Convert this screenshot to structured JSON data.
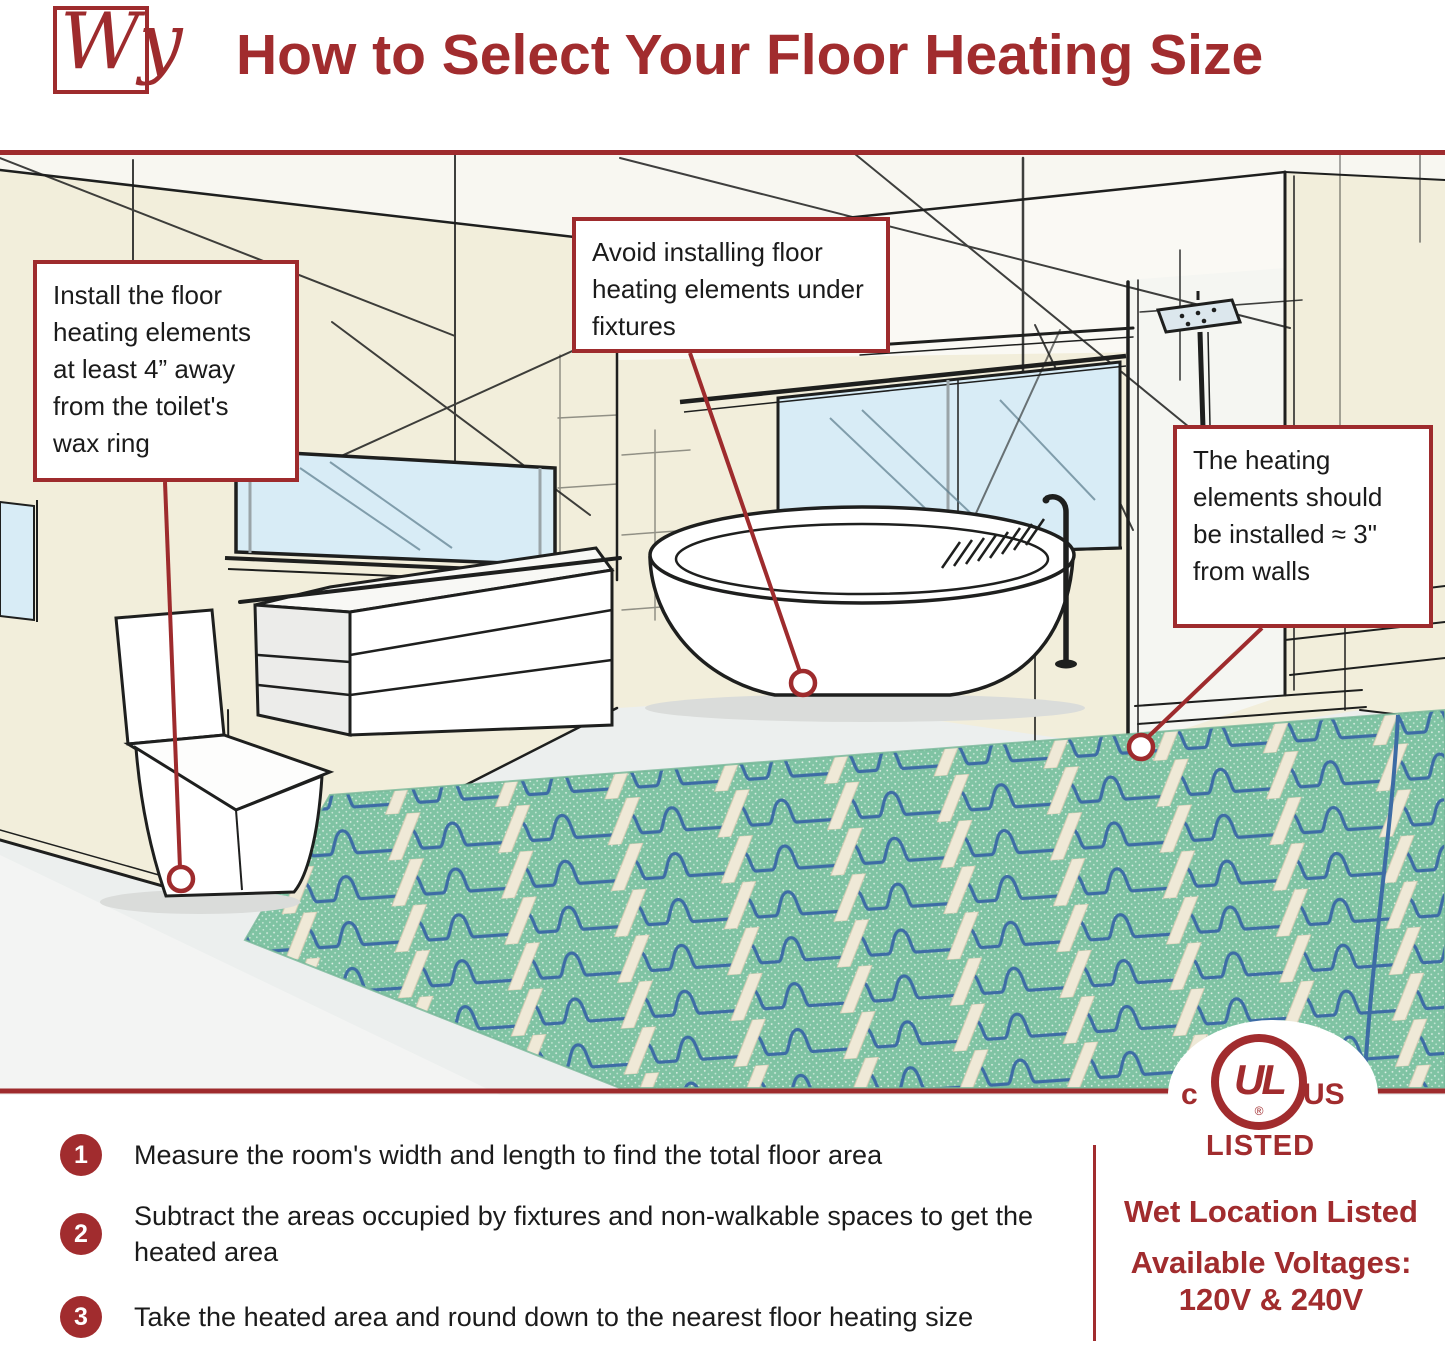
{
  "header": {
    "logo_text": "Wy",
    "title": "How to Select Your Floor Heating Size"
  },
  "callouts": [
    {
      "text": "Install the floor heating elements at least 4” away from the toilet's wax ring"
    },
    {
      "text": "Avoid installing floor heating elements under fixtures"
    },
    {
      "text": "The heating elements should be installed ≈ 3\" from walls"
    }
  ],
  "steps": [
    {
      "number": "1",
      "text": "Measure the room's width and length to find the total floor area"
    },
    {
      "number": "2",
      "text": "Subtract the areas occupied by fixtures and non-walkable spaces to get the heated area"
    },
    {
      "number": "3",
      "text": "Take the heated area and round down to the nearest floor heating size"
    }
  ],
  "certification": {
    "left_mark": "c",
    "center_mark": "UL",
    "registered": "®",
    "right_mark": "US",
    "listed_label": "LISTED",
    "wet_location": "Wet Location Listed",
    "voltages_label": "Available Voltages:",
    "voltages_value": "120V & 240V"
  },
  "colors": {
    "accent_red": "#9E2B2D",
    "wall_cream": "#F2EEDB",
    "window_blue": "#D8ECF6",
    "mat_green": "#85C9A9",
    "cable_blue": "#3D6CA5",
    "floor_gray": "#ECEFEE"
  }
}
